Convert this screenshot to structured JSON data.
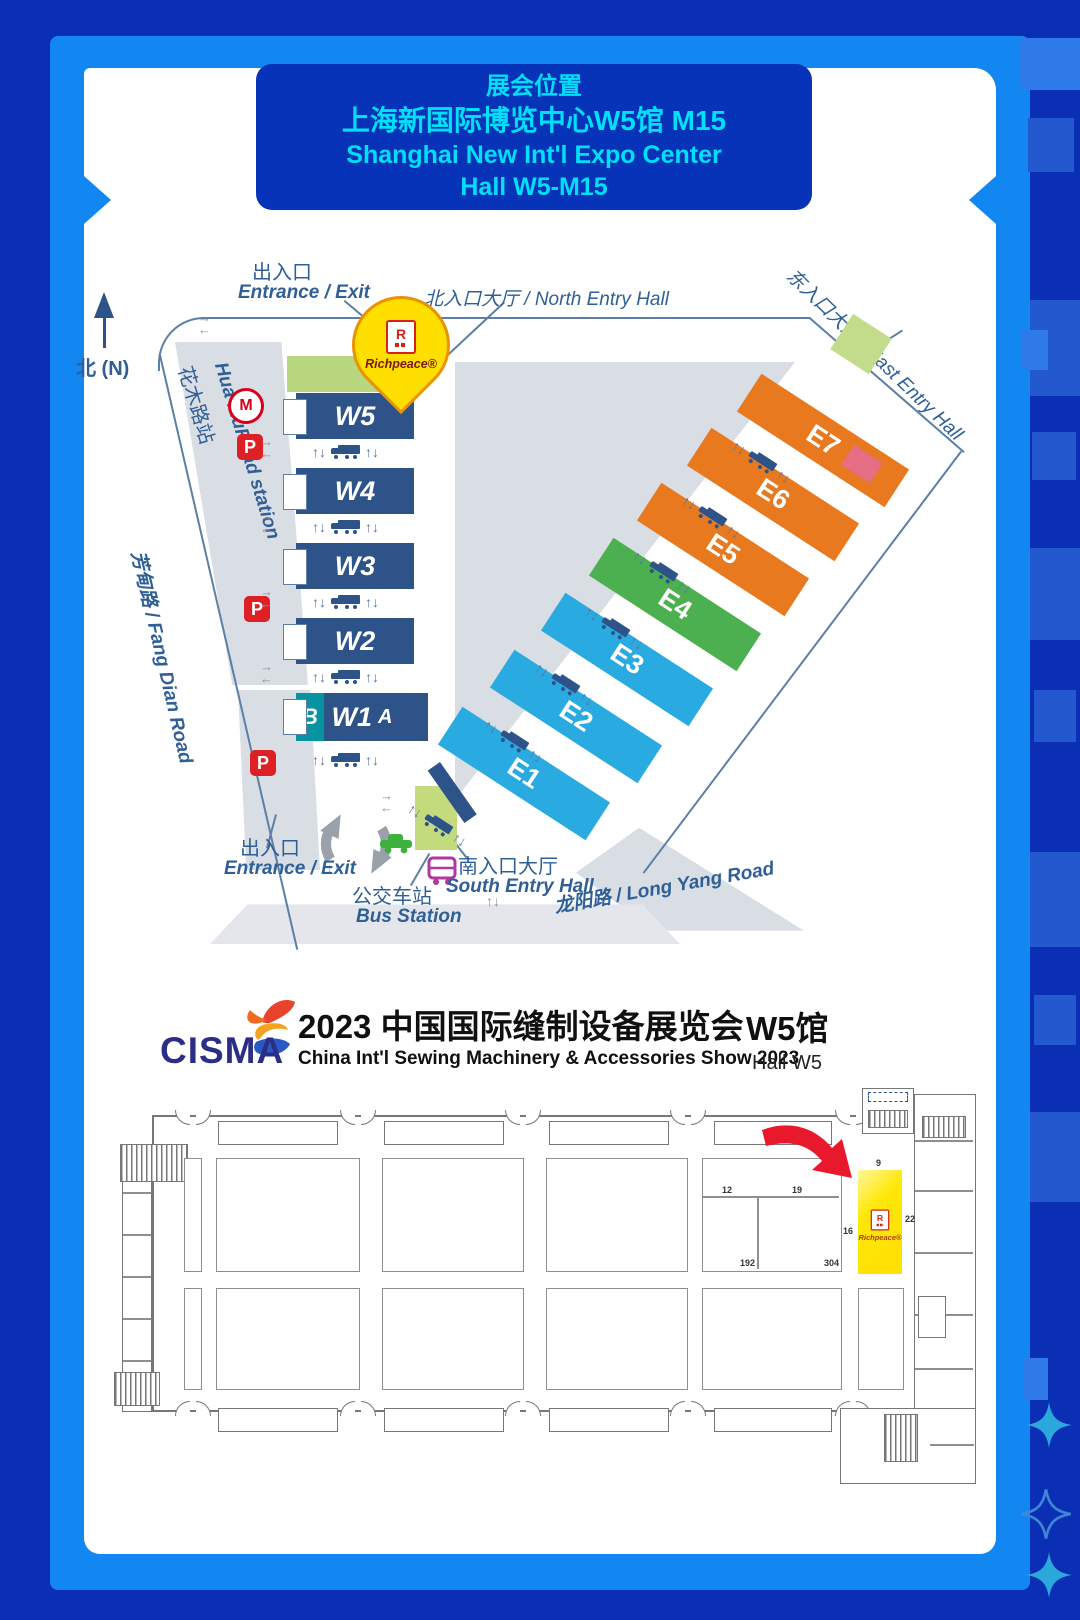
{
  "colors": {
    "frame_outer": "#0a2fb5",
    "frame_inner": "#1287f2",
    "header_bg": "#0733b8",
    "header_text": "#00dffc",
    "w_hall": "#2e5389",
    "e_blue": "#29abe2",
    "e_green": "#4cb050",
    "e_orange": "#e8791e",
    "e7_corner": "#e56e85",
    "entry_green": "#c3db7c",
    "map_gray": "#d9dde4",
    "label_blue": "#2f5f96",
    "parking_red": "#dd2025",
    "pin_yellow": "#ffdf00",
    "booth_yellow": "#ffe70a",
    "arrow_red": "#e8192c",
    "cisma_navy": "#2b2e87"
  },
  "header": {
    "title": "展会位置",
    "venue_zh": "上海新国际博览中心W5馆 M15",
    "venue_en": "Shanghai New Int'l Expo Center",
    "hall": "Hall W5-M15"
  },
  "map": {
    "north": "北 (N)",
    "entrance_top_zh": "出入口",
    "entrance_top_en": "Entrance / Exit",
    "north_entry": "北入口大厅 / North Entry Hall",
    "east_entry": "东入口大厅 / East Entry Hall",
    "south_entry_zh": "南入口大厅",
    "south_entry_en": "South Entry Hall",
    "bus_zh": "公交车站",
    "bus_en": "Bus Station",
    "entrance_bottom_zh": "出入口",
    "entrance_bottom_en": "Entrance / Exit",
    "station_zh": "花木路站",
    "station_en": "Hua MuRoad station",
    "fangdian": "芳甸路 / Fang Dian Road",
    "longyang": "龙阳路 / Long Yang Road",
    "w_halls": [
      "W5",
      "W4",
      "W3",
      "W2",
      "W1"
    ],
    "w1_a": "A",
    "w1_b": "B",
    "e_halls": [
      "E1",
      "E2",
      "E3",
      "E4",
      "E5",
      "E6",
      "E7"
    ],
    "parking": "P",
    "metro": "M",
    "pin": {
      "r": "R",
      "brand": "Richpeace®"
    }
  },
  "icons": {
    "ud": "↑↓",
    "right": "→",
    "left": "←"
  },
  "cisma": {
    "logo": "CISMA",
    "title": "2023 中国国际缝制设备展览会",
    "subtitle": "China Int'l Sewing Machinery & Accessories Show 2023",
    "hall_zh": "W5馆",
    "hall_en": "Hall  W5"
  },
  "plan": {
    "brand_r": "R",
    "brand": "Richpeace®",
    "n9": "9",
    "n22": "22",
    "n16": "16",
    "n12": "12",
    "n19": "19",
    "n192": "192",
    "n304": "304"
  }
}
